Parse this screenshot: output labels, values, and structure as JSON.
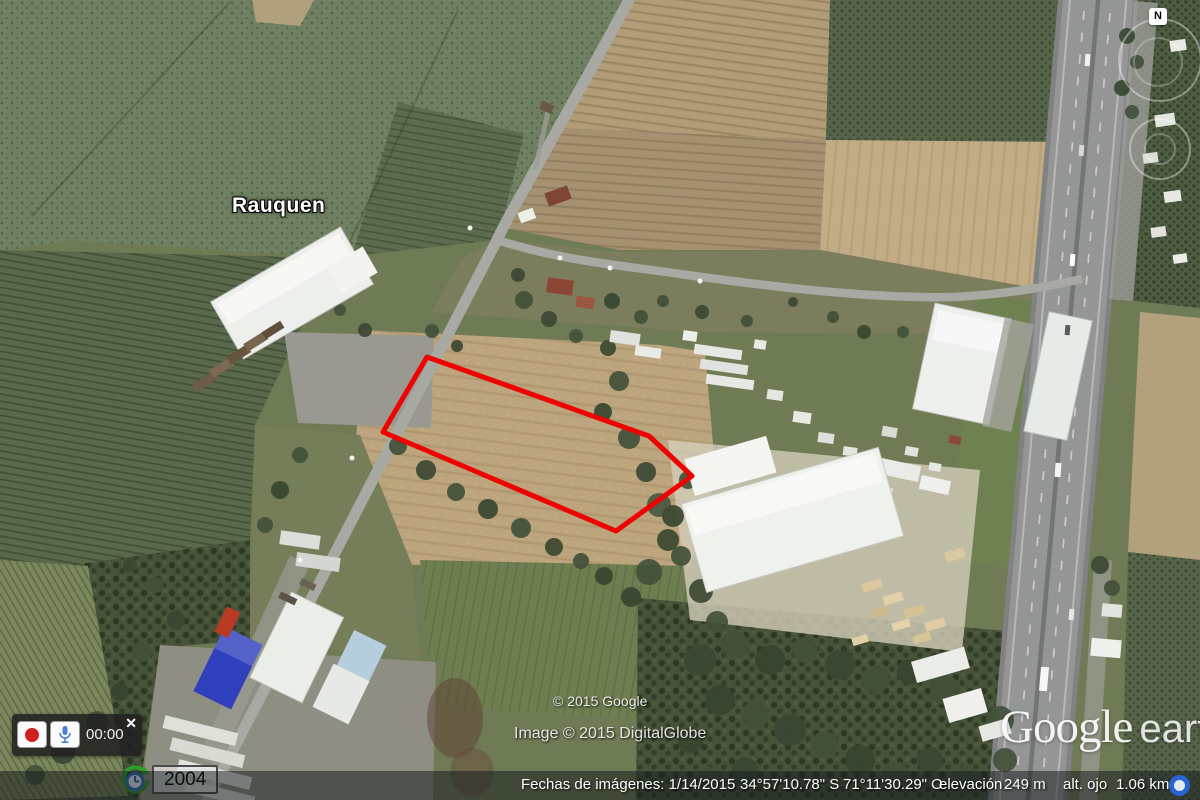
{
  "map": {
    "place_label": "Rauquen",
    "copyright_google": "© 2015 Google",
    "copyright_digitalglobe": "Image © 2015 DigitalGlobe"
  },
  "logo": {
    "google": "Google",
    "earth": "earth"
  },
  "navigation": {
    "compass_label": "N"
  },
  "recorder": {
    "timer": "00:00",
    "close_label": "✕"
  },
  "timeline": {
    "year": "2004"
  },
  "status_bar": {
    "imagery_date": "Fechas de imágenes: 1/14/2015",
    "latitude": "34°57'10.78\" S",
    "longitude": "71°11'30.29\" O",
    "elevation_label": "elevación",
    "elevation_value": "249 m",
    "eye_altitude_label": "alt. ojo",
    "eye_altitude_value": "1.06 km"
  },
  "colors": {
    "parcel_outline": "#ee0202",
    "record_red": "#cf2020",
    "mic_blue": "#4a7fd8",
    "status_indicator_blue": "#2a64d4"
  }
}
